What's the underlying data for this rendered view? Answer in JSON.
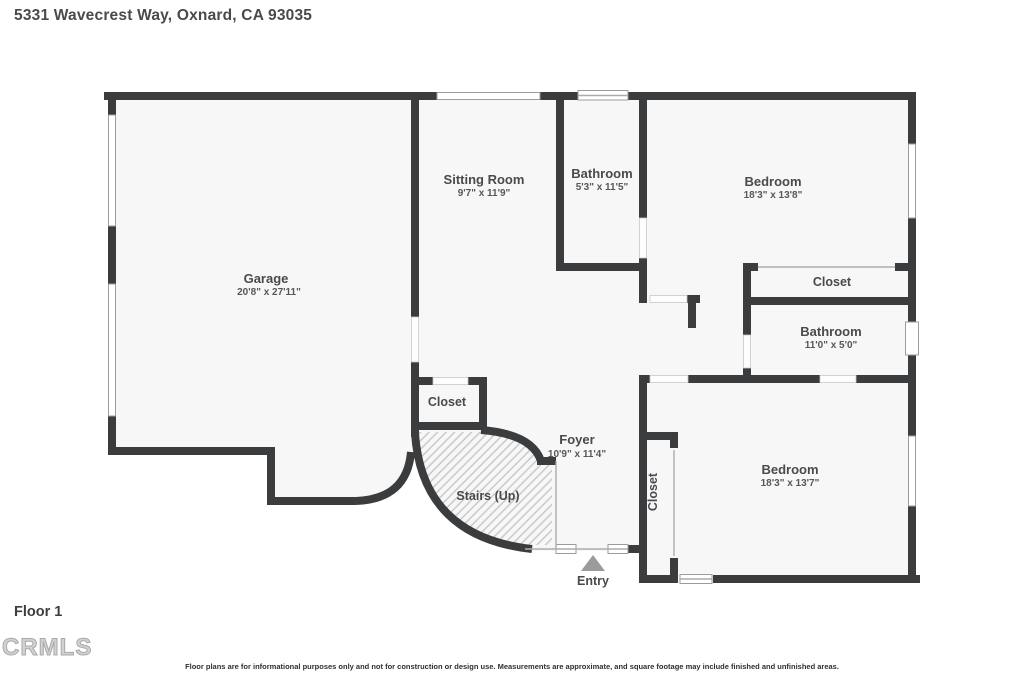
{
  "header": {
    "title": "5331 Wavecrest Way, Oxnard, CA 93035"
  },
  "floor_label": "Floor 1",
  "logo_text": "CRMLS",
  "disclaimer": "Floor plans are for informational purposes only and not for construction or design use. Measurements are approximate, and square footage may include finished and unfinished areas.",
  "colors": {
    "wall": "#3a3c3e",
    "room_fill": "#f7f7f8",
    "hatch_line": "#c2c2c2",
    "entry_arrow": "#9b9b9b"
  },
  "rooms": {
    "garage": {
      "name": "Garage",
      "dims": "20'8\" x 27'11\""
    },
    "sitting_room": {
      "name": "Sitting Room",
      "dims": "9'7\" x 11'9\""
    },
    "bathroom_upper": {
      "name": "Bathroom",
      "dims": "5'3\" x 11'5\""
    },
    "bedroom_upper": {
      "name": "Bedroom",
      "dims": "18'3\" x 13'8\""
    },
    "closet_upper": {
      "name": "Closet"
    },
    "bathroom_hall": {
      "name": "Bathroom",
      "dims": "11'0\" x 5'0\""
    },
    "closet_foyer": {
      "name": "Closet"
    },
    "foyer": {
      "name": "Foyer",
      "dims": "10'9\" x 11'4\""
    },
    "stairs": {
      "name": "Stairs (Up)"
    },
    "closet_bedroom": {
      "name": "Closet"
    },
    "bedroom_lower": {
      "name": "Bedroom",
      "dims": "18'3\" x 13'7\""
    },
    "entry": {
      "name": "Entry"
    }
  }
}
